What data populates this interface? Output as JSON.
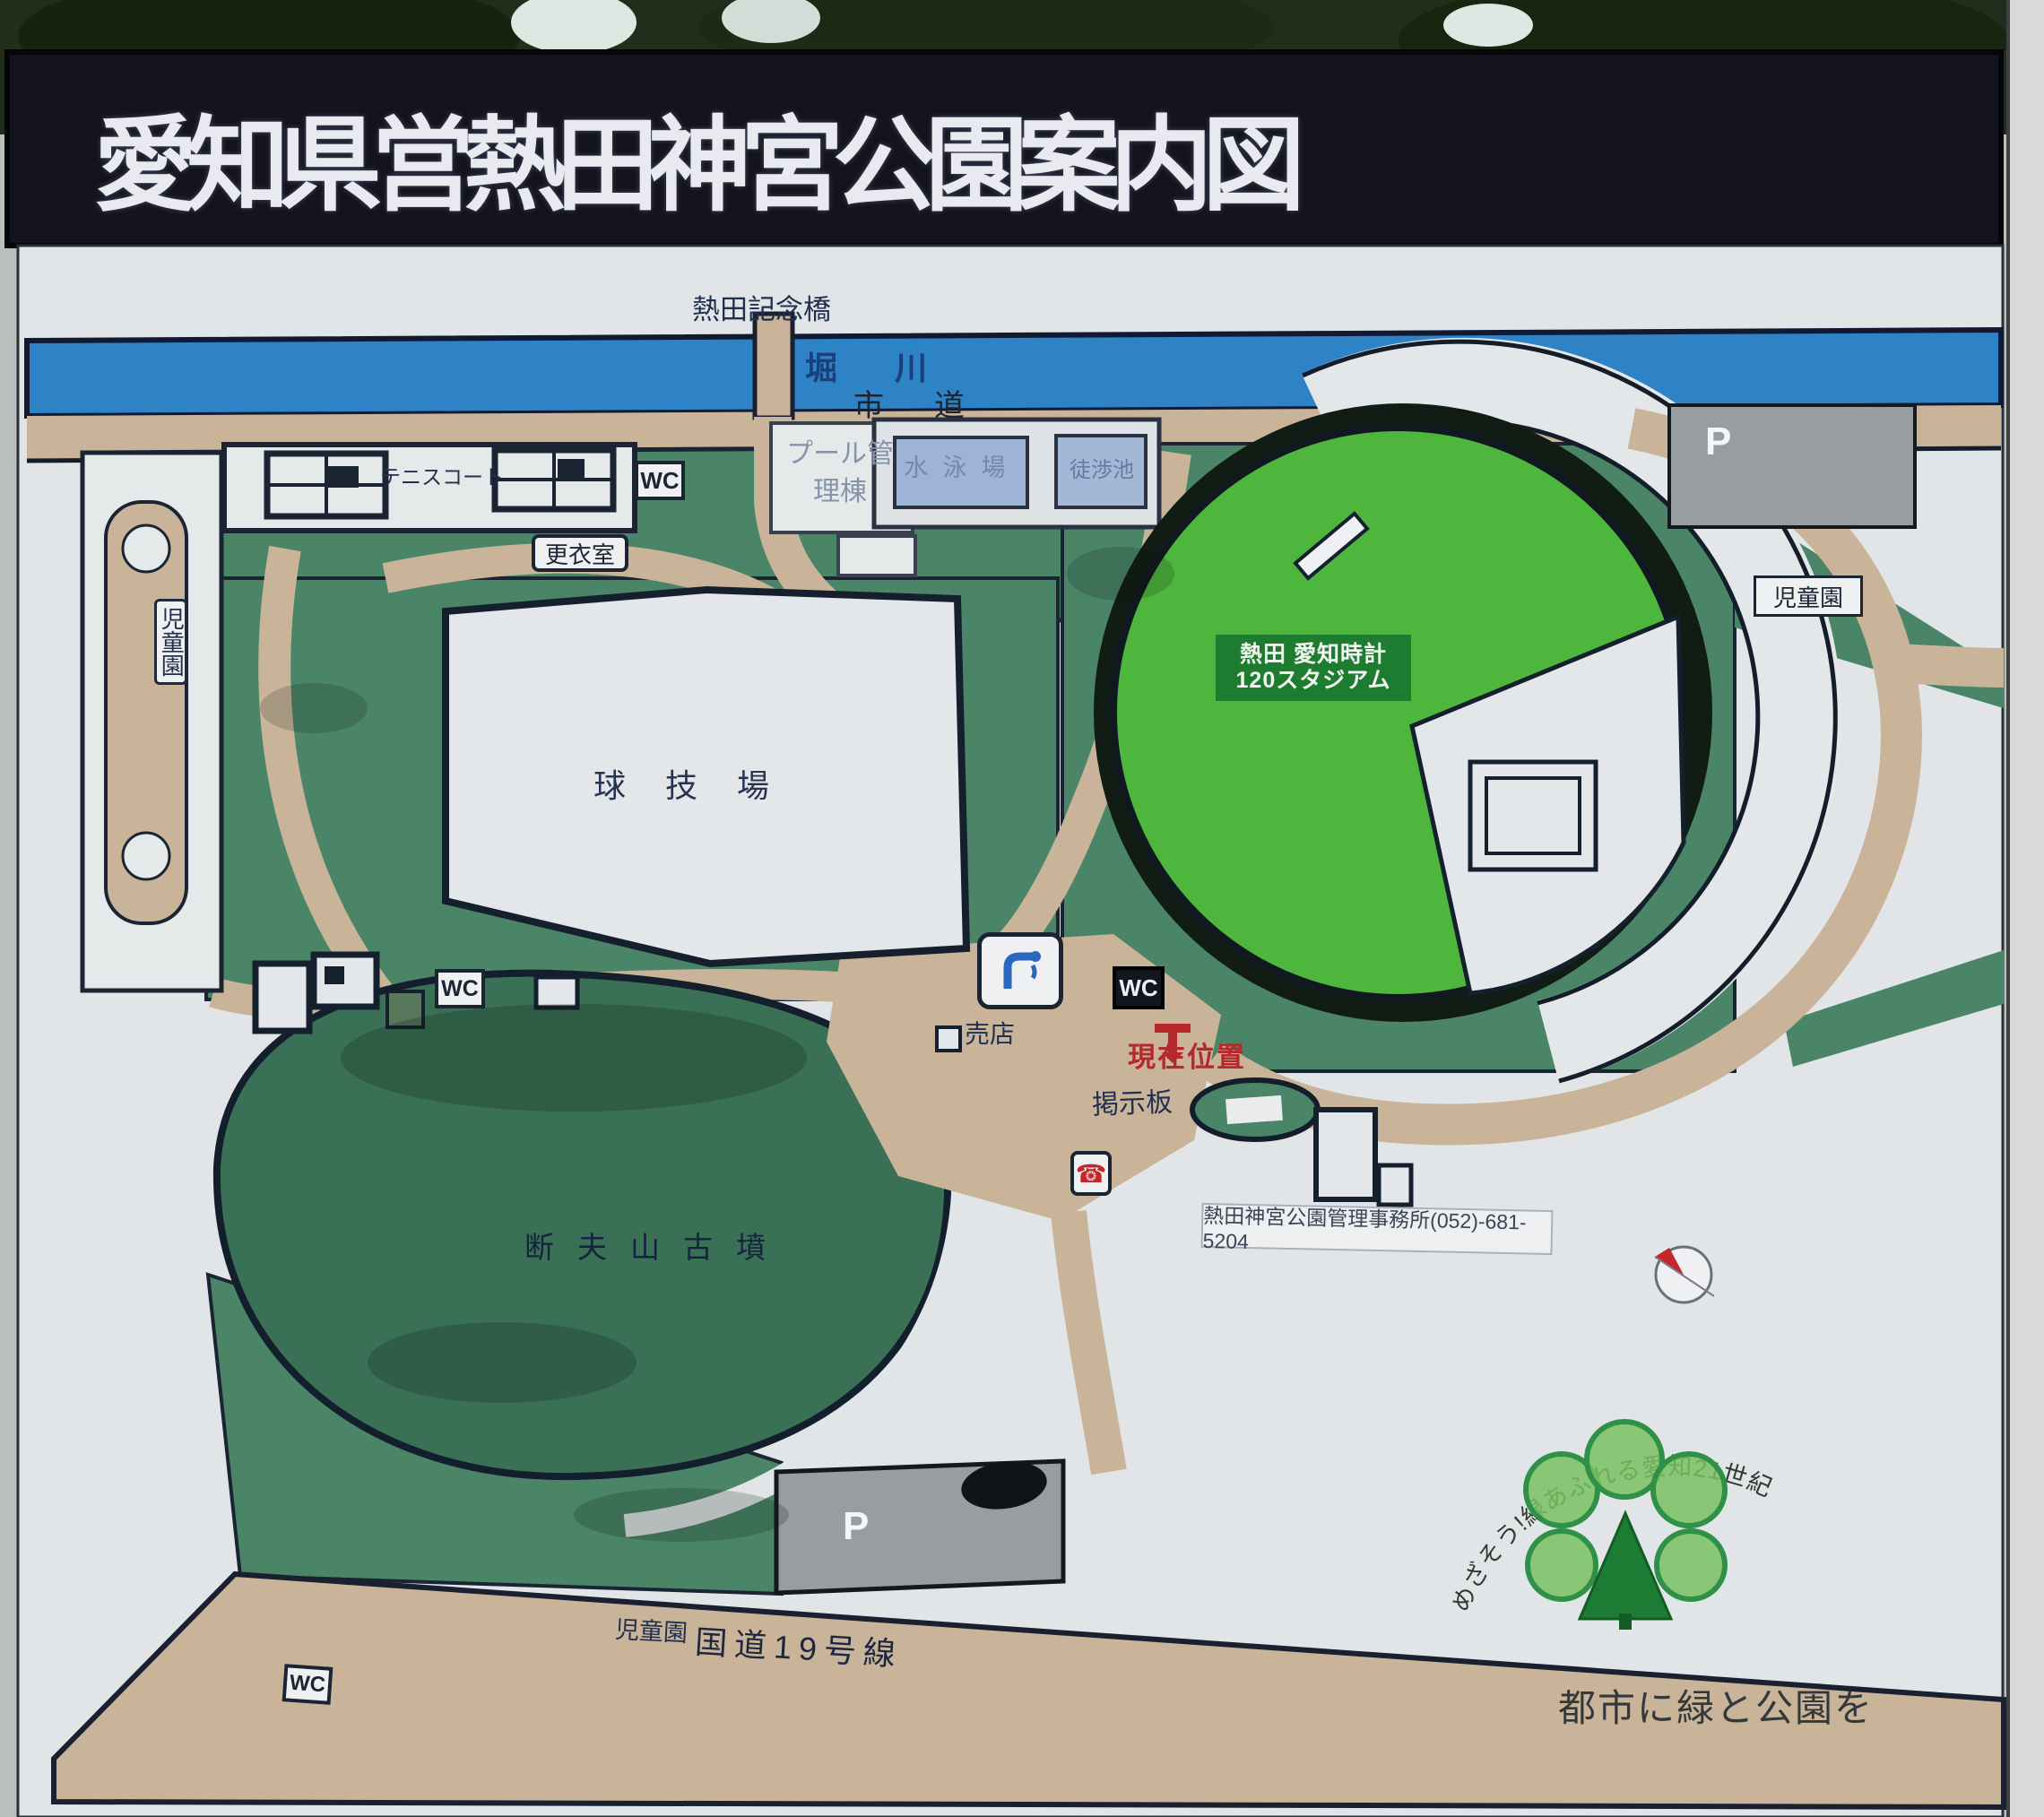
{
  "title": "愛知県営熱田神宮公園案内図",
  "colors": {
    "park_green": "#4a8568",
    "mound_green": "#3a7055",
    "stadium_green": "#4eb63c",
    "river_blue": "#2e82c6",
    "path_tan": "#c9b49a",
    "board_white": "#e2e5e7",
    "accent_red": "#b5292c",
    "label_navy": "#22304f",
    "parking_gray": "#989da0",
    "title_bg": "#14141c",
    "stadium_tag_green": "#1e7c31"
  },
  "labels": {
    "bridge": "熱田記念橋",
    "river": "堀川",
    "city_road": "市道",
    "tennis_court": "テニスコート",
    "wc": "WC",
    "changing_room": "更衣室",
    "pool_building": "プール管理棟",
    "pool_main": "水泳場",
    "wading_pool": "徒渉池",
    "stadium_line1": "熱田 愛知時計",
    "stadium_line2": "120スタジアム",
    "ball_field": "球技場",
    "children_garden": "児童園",
    "shop": "売店",
    "current_location": "現在位置",
    "bulletin_board": "掲示板",
    "office_phone": "熱田神宮公園管理事務所(052)-681-5204",
    "mound": "断夫山古墳",
    "parking": "P",
    "route_19": "国道19号線",
    "slogan_arc": "めざそう!緑あふれる愛知21世紀",
    "slogan_main": "都市に緑と公園を"
  },
  "icons": {
    "phone": "☎"
  }
}
